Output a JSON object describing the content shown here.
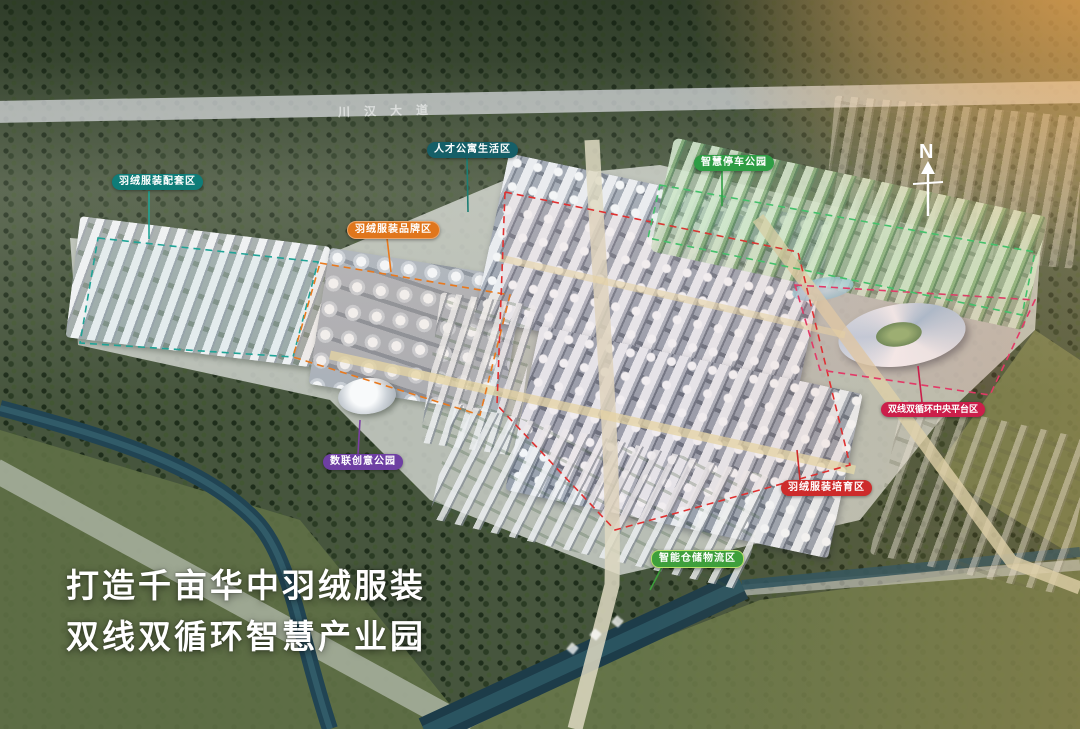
{
  "scene": {
    "slogan_line1": "打造千亩华中羽绒服装",
    "slogan_line2": "双线双循环智慧产业园",
    "compass_label": "N",
    "road_name": "川汉大道"
  },
  "zones": [
    {
      "key": "outfit-support",
      "label": "羽绒服装配套区",
      "color": "#0e7c78"
    },
    {
      "key": "talent-living",
      "label": "人才公寓生活区",
      "color": "#155f68"
    },
    {
      "key": "smart-parking",
      "label": "智慧停车公园",
      "color": "#2e9d44"
    },
    {
      "key": "brand-zone",
      "label": "羽绒服装品牌区",
      "color": "#e0761c"
    },
    {
      "key": "data-creative",
      "label": "数联创意公园",
      "color": "#6e3fa3"
    },
    {
      "key": "central-platform",
      "label": "双线双循环中央平台区",
      "color": "#cb1e4a"
    },
    {
      "key": "incubation",
      "label": "羽绒服装培育区",
      "color": "#cd2b2b"
    },
    {
      "key": "smart-logistics",
      "label": "智能仓储物流区",
      "color": "#3e9f3c"
    }
  ]
}
